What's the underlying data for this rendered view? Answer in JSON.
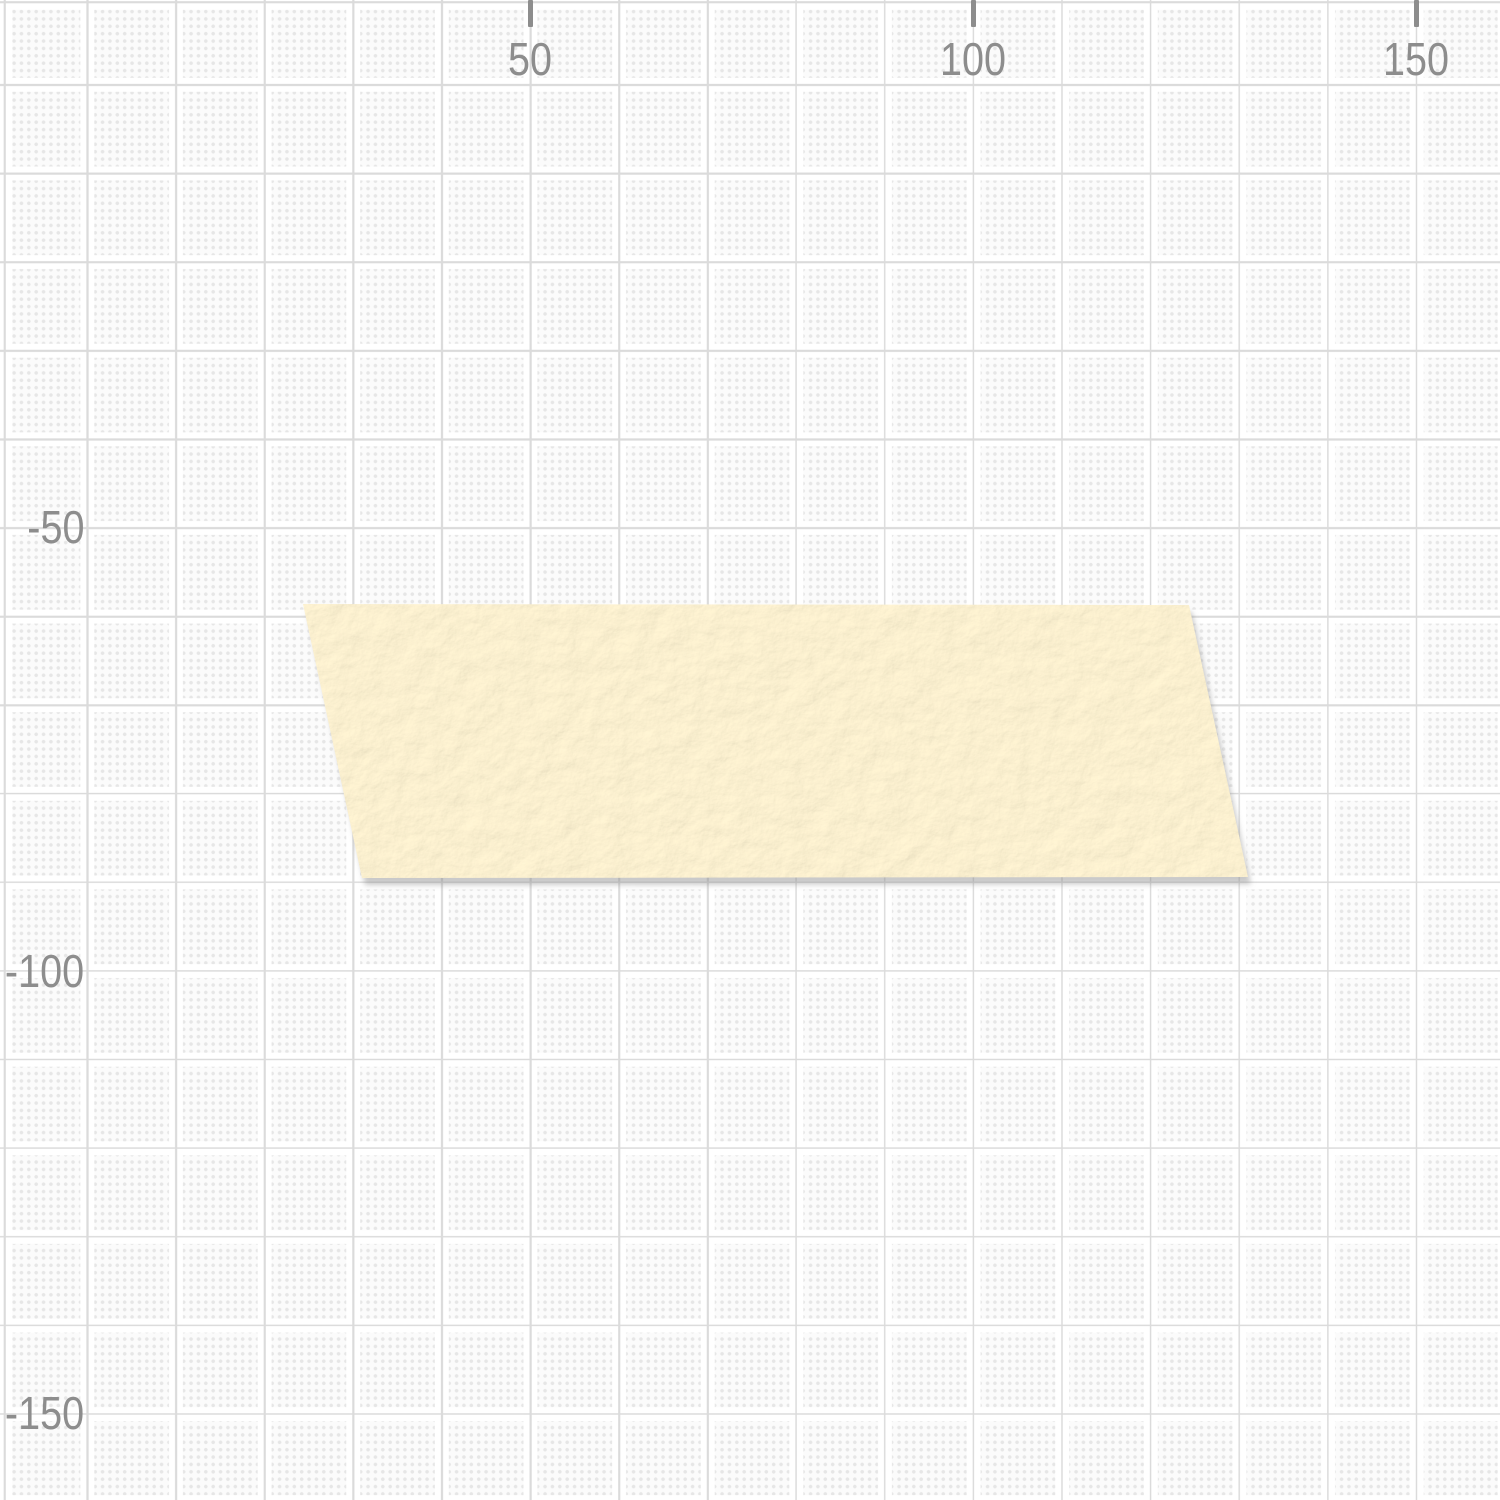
{
  "canvas": {
    "grid": {
      "background_color": "#fbfbfb",
      "dot_color": "#e6e6e6",
      "major_line_color": "#dbdbdb",
      "major_line_gutter_color": "#ffffff"
    },
    "rulers": {
      "tick_color": "#8d8d8d",
      "label_color": "#8d8d8d",
      "top_labels": [
        {
          "value": "50"
        },
        {
          "value": "100"
        },
        {
          "value": "150"
        }
      ],
      "left_labels": [
        {
          "value": "-50"
        },
        {
          "value": "-100"
        },
        {
          "value": "-150"
        }
      ]
    }
  },
  "objects": {
    "tape": {
      "kind": "washi-tape-strip",
      "fill_color": "#f5e7c1",
      "shadow_color": "rgba(135,135,135,0.45)"
    }
  }
}
